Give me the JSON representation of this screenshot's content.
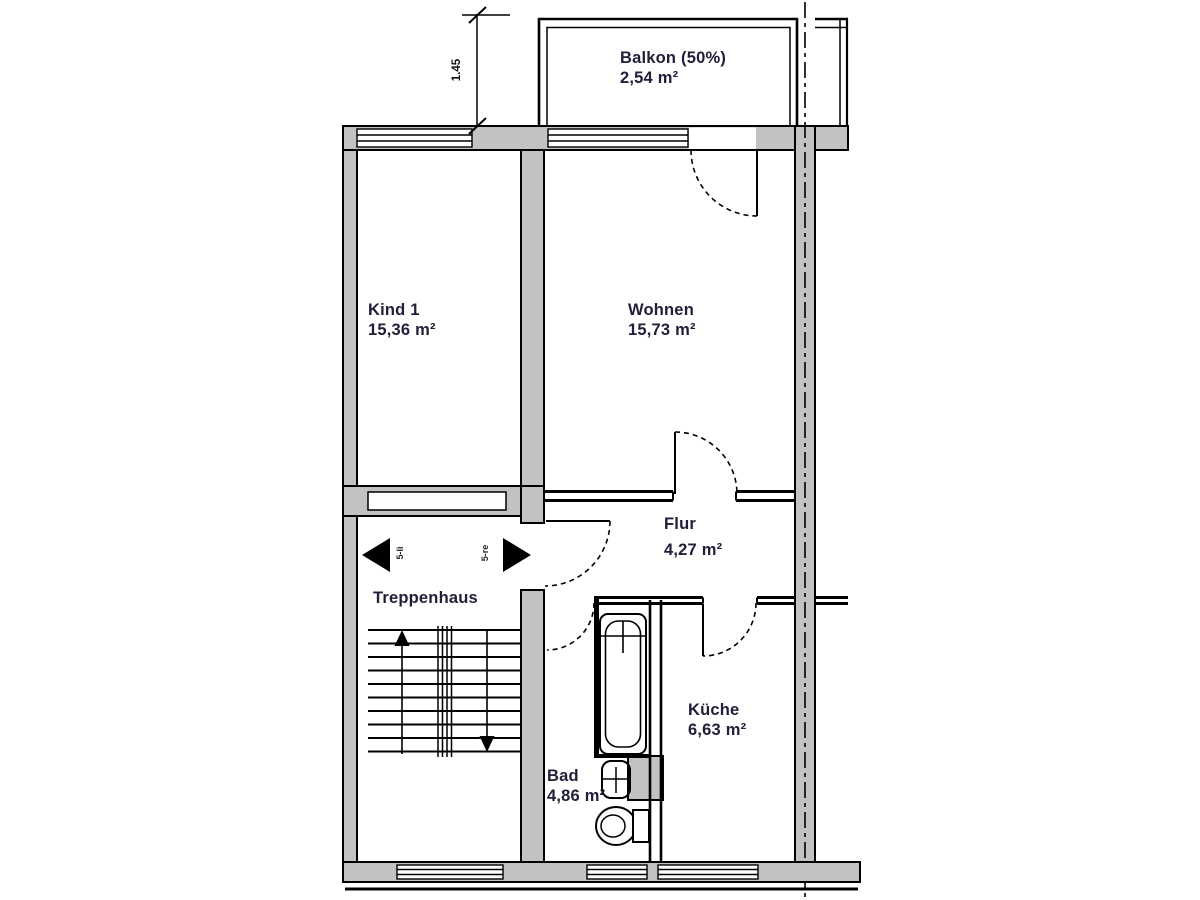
{
  "drawing": {
    "type": "floor-plan",
    "language": "de"
  },
  "rooms": {
    "balkon": {
      "name": "Balkon (50%)",
      "area": "2,54 m²"
    },
    "kind1": {
      "name": "Kind 1",
      "area": "15,36 m²"
    },
    "wohnen": {
      "name": "Wohnen",
      "area": "15,73 m²"
    },
    "flur": {
      "name": "Flur",
      "area": "4,27 m²"
    },
    "treppenhaus": {
      "name": "Treppenhaus"
    },
    "bad": {
      "name": "Bad",
      "area": "4,86 m²"
    },
    "kueche": {
      "name": "Küche",
      "area": "6,63 m²"
    }
  },
  "annotations": {
    "dimension_vertical": "1.45",
    "door_label_left": "5-li",
    "door_label_right": "5-re"
  },
  "colors": {
    "wall_fill": "#c2c2c2",
    "line": "#000000",
    "label_text": "#20203a"
  }
}
